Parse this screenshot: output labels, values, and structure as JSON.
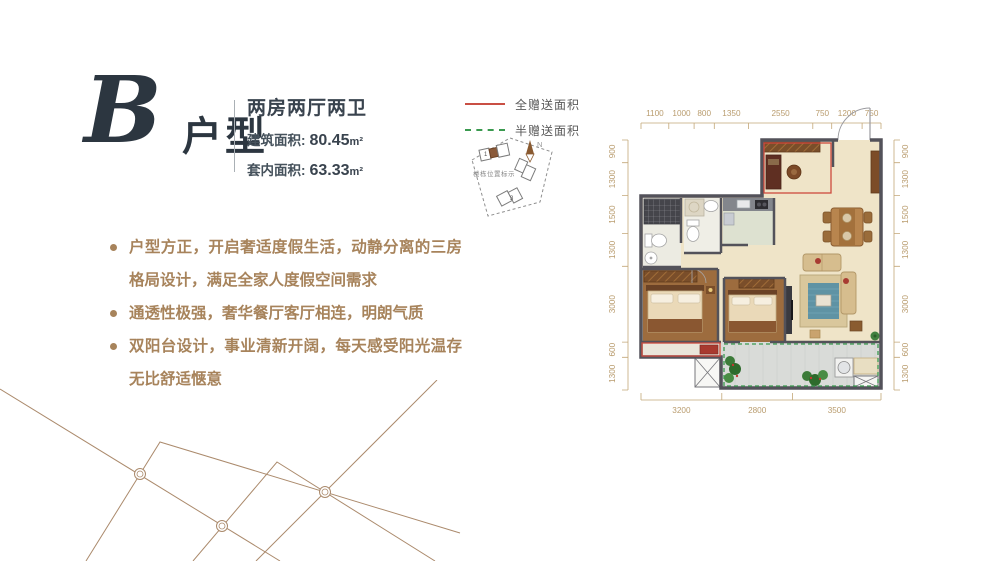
{
  "header": {
    "type_letter": "B",
    "type_suffix": "户型",
    "layout_name": "两房两厅两卫",
    "areas": [
      {
        "label": "建筑面积:",
        "value": "80.45",
        "unit": "m²"
      },
      {
        "label": "套内面积:",
        "value": "63.33",
        "unit": "m²"
      }
    ]
  },
  "features": [
    "户型方正，开启奢适度假生活，动静分离的三房格局设计，满足全家人度假空间需求",
    "通透性极强，奢华餐厅客厅相连，明朗气质",
    "双阳台设计，事业清新开阔，每天感受阳光温存无比舒适惬意"
  ],
  "legend": {
    "full_gift": "全赠送面积",
    "half_gift": "半赠送面积",
    "full_color": "#c94f44",
    "half_color": "#3a9a4f"
  },
  "site_marker": {
    "label": "楼栋位置标示",
    "compass": "N",
    "building_1": "1",
    "building_2": "3"
  },
  "floor_plan": {
    "dims_top": [
      "1100",
      "1000",
      "800",
      "1350",
      "2550",
      "750",
      "1200",
      "750"
    ],
    "dims_bottom": [
      "3200",
      "2800",
      "3500"
    ],
    "dims_left": [
      "900",
      "1300",
      "1500",
      "1300",
      "3000",
      "600",
      "1300"
    ],
    "dims_right": [
      "900",
      "1300",
      "1500",
      "1300",
      "3000",
      "600",
      "1300"
    ]
  }
}
